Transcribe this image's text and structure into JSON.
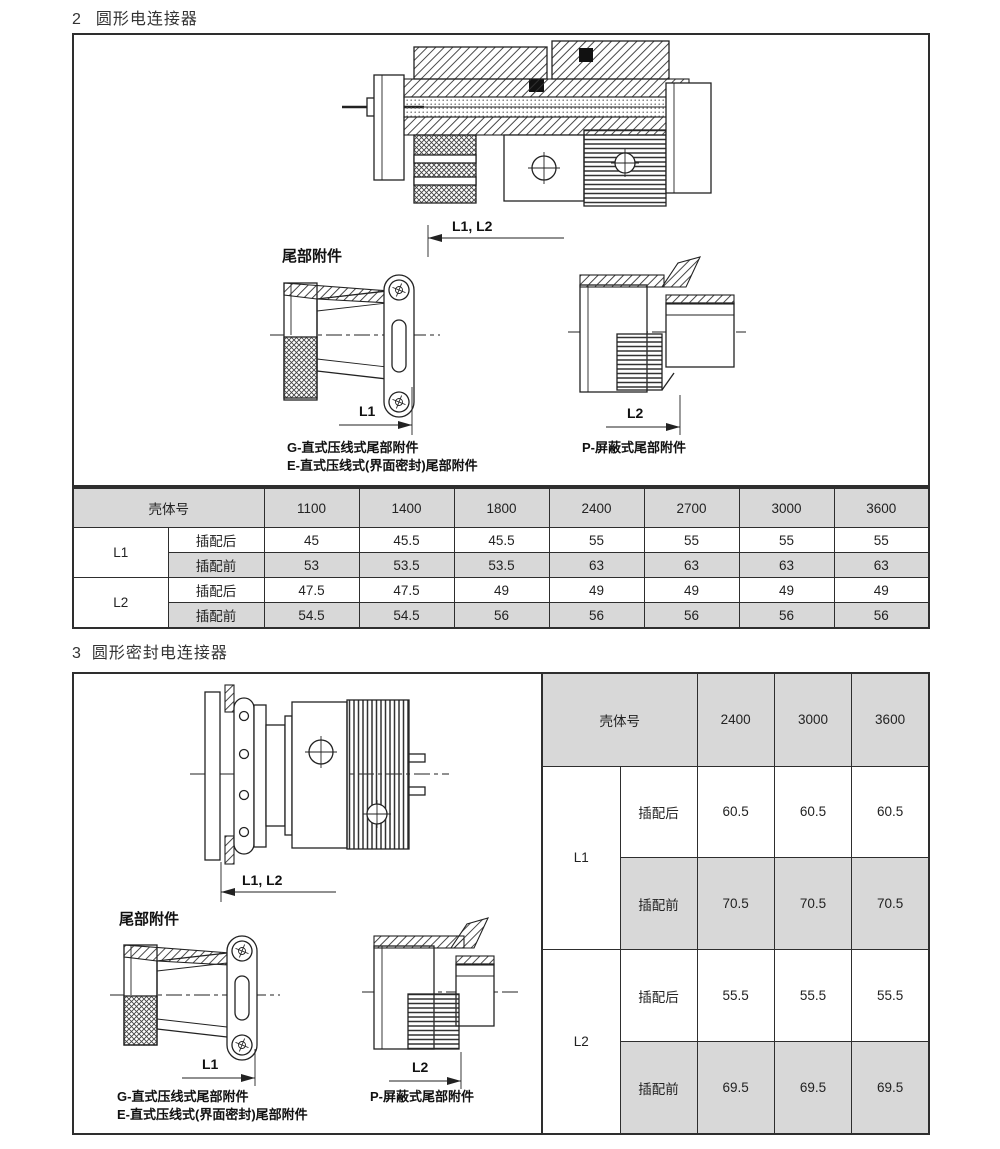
{
  "colors": {
    "shade": "#d8d8d8",
    "border": "#2e2e2e",
    "line": "#222222"
  },
  "section2": {
    "number": "2",
    "title": "圆形电连接器",
    "tail_heading": "尾部附件",
    "dims": {
      "l1l2": "L1, L2",
      "l1": "L1",
      "l2": "L2"
    },
    "captions": {
      "g": "G-直式压线式尾部附件",
      "e": "E-直式压线式(界面密封)尾部附件",
      "p": "P-屏蔽式尾部附件"
    },
    "table": {
      "header_label": "壳体号",
      "shell_sizes": [
        "1100",
        "1400",
        "1800",
        "2400",
        "2700",
        "3000",
        "3600"
      ],
      "rows": [
        {
          "group": "L1",
          "cond": "插配后",
          "values": [
            "45",
            "45.5",
            "45.5",
            "55",
            "55",
            "55",
            "55"
          ]
        },
        {
          "group": "L1",
          "cond": "插配前",
          "values": [
            "53",
            "53.5",
            "53.5",
            "63",
            "63",
            "63",
            "63"
          ]
        },
        {
          "group": "L2",
          "cond": "插配后",
          "values": [
            "47.5",
            "47.5",
            "49",
            "49",
            "49",
            "49",
            "49"
          ]
        },
        {
          "group": "L2",
          "cond": "插配前",
          "values": [
            "54.5",
            "54.5",
            "56",
            "56",
            "56",
            "56",
            "56"
          ]
        }
      ]
    }
  },
  "section3": {
    "number": "3",
    "title": "圆形密封电连接器",
    "tail_heading": "尾部附件",
    "dims": {
      "l1l2": "L1, L2",
      "l1": "L1",
      "l2": "L2"
    },
    "captions": {
      "g": "G-直式压线式尾部附件",
      "e": "E-直式压线式(界面密封)尾部附件",
      "p": "P-屏蔽式尾部附件"
    },
    "table": {
      "header_label": "壳体号",
      "shell_sizes": [
        "2400",
        "3000",
        "3600"
      ],
      "rows": [
        {
          "group": "L1",
          "cond": "插配后",
          "values": [
            "60.5",
            "60.5",
            "60.5"
          ]
        },
        {
          "group": "L1",
          "cond": "插配前",
          "values": [
            "70.5",
            "70.5",
            "70.5"
          ]
        },
        {
          "group": "L2",
          "cond": "插配后",
          "values": [
            "55.5",
            "55.5",
            "55.5"
          ]
        },
        {
          "group": "L2",
          "cond": "插配前",
          "values": [
            "69.5",
            "69.5",
            "69.5"
          ]
        }
      ]
    }
  }
}
